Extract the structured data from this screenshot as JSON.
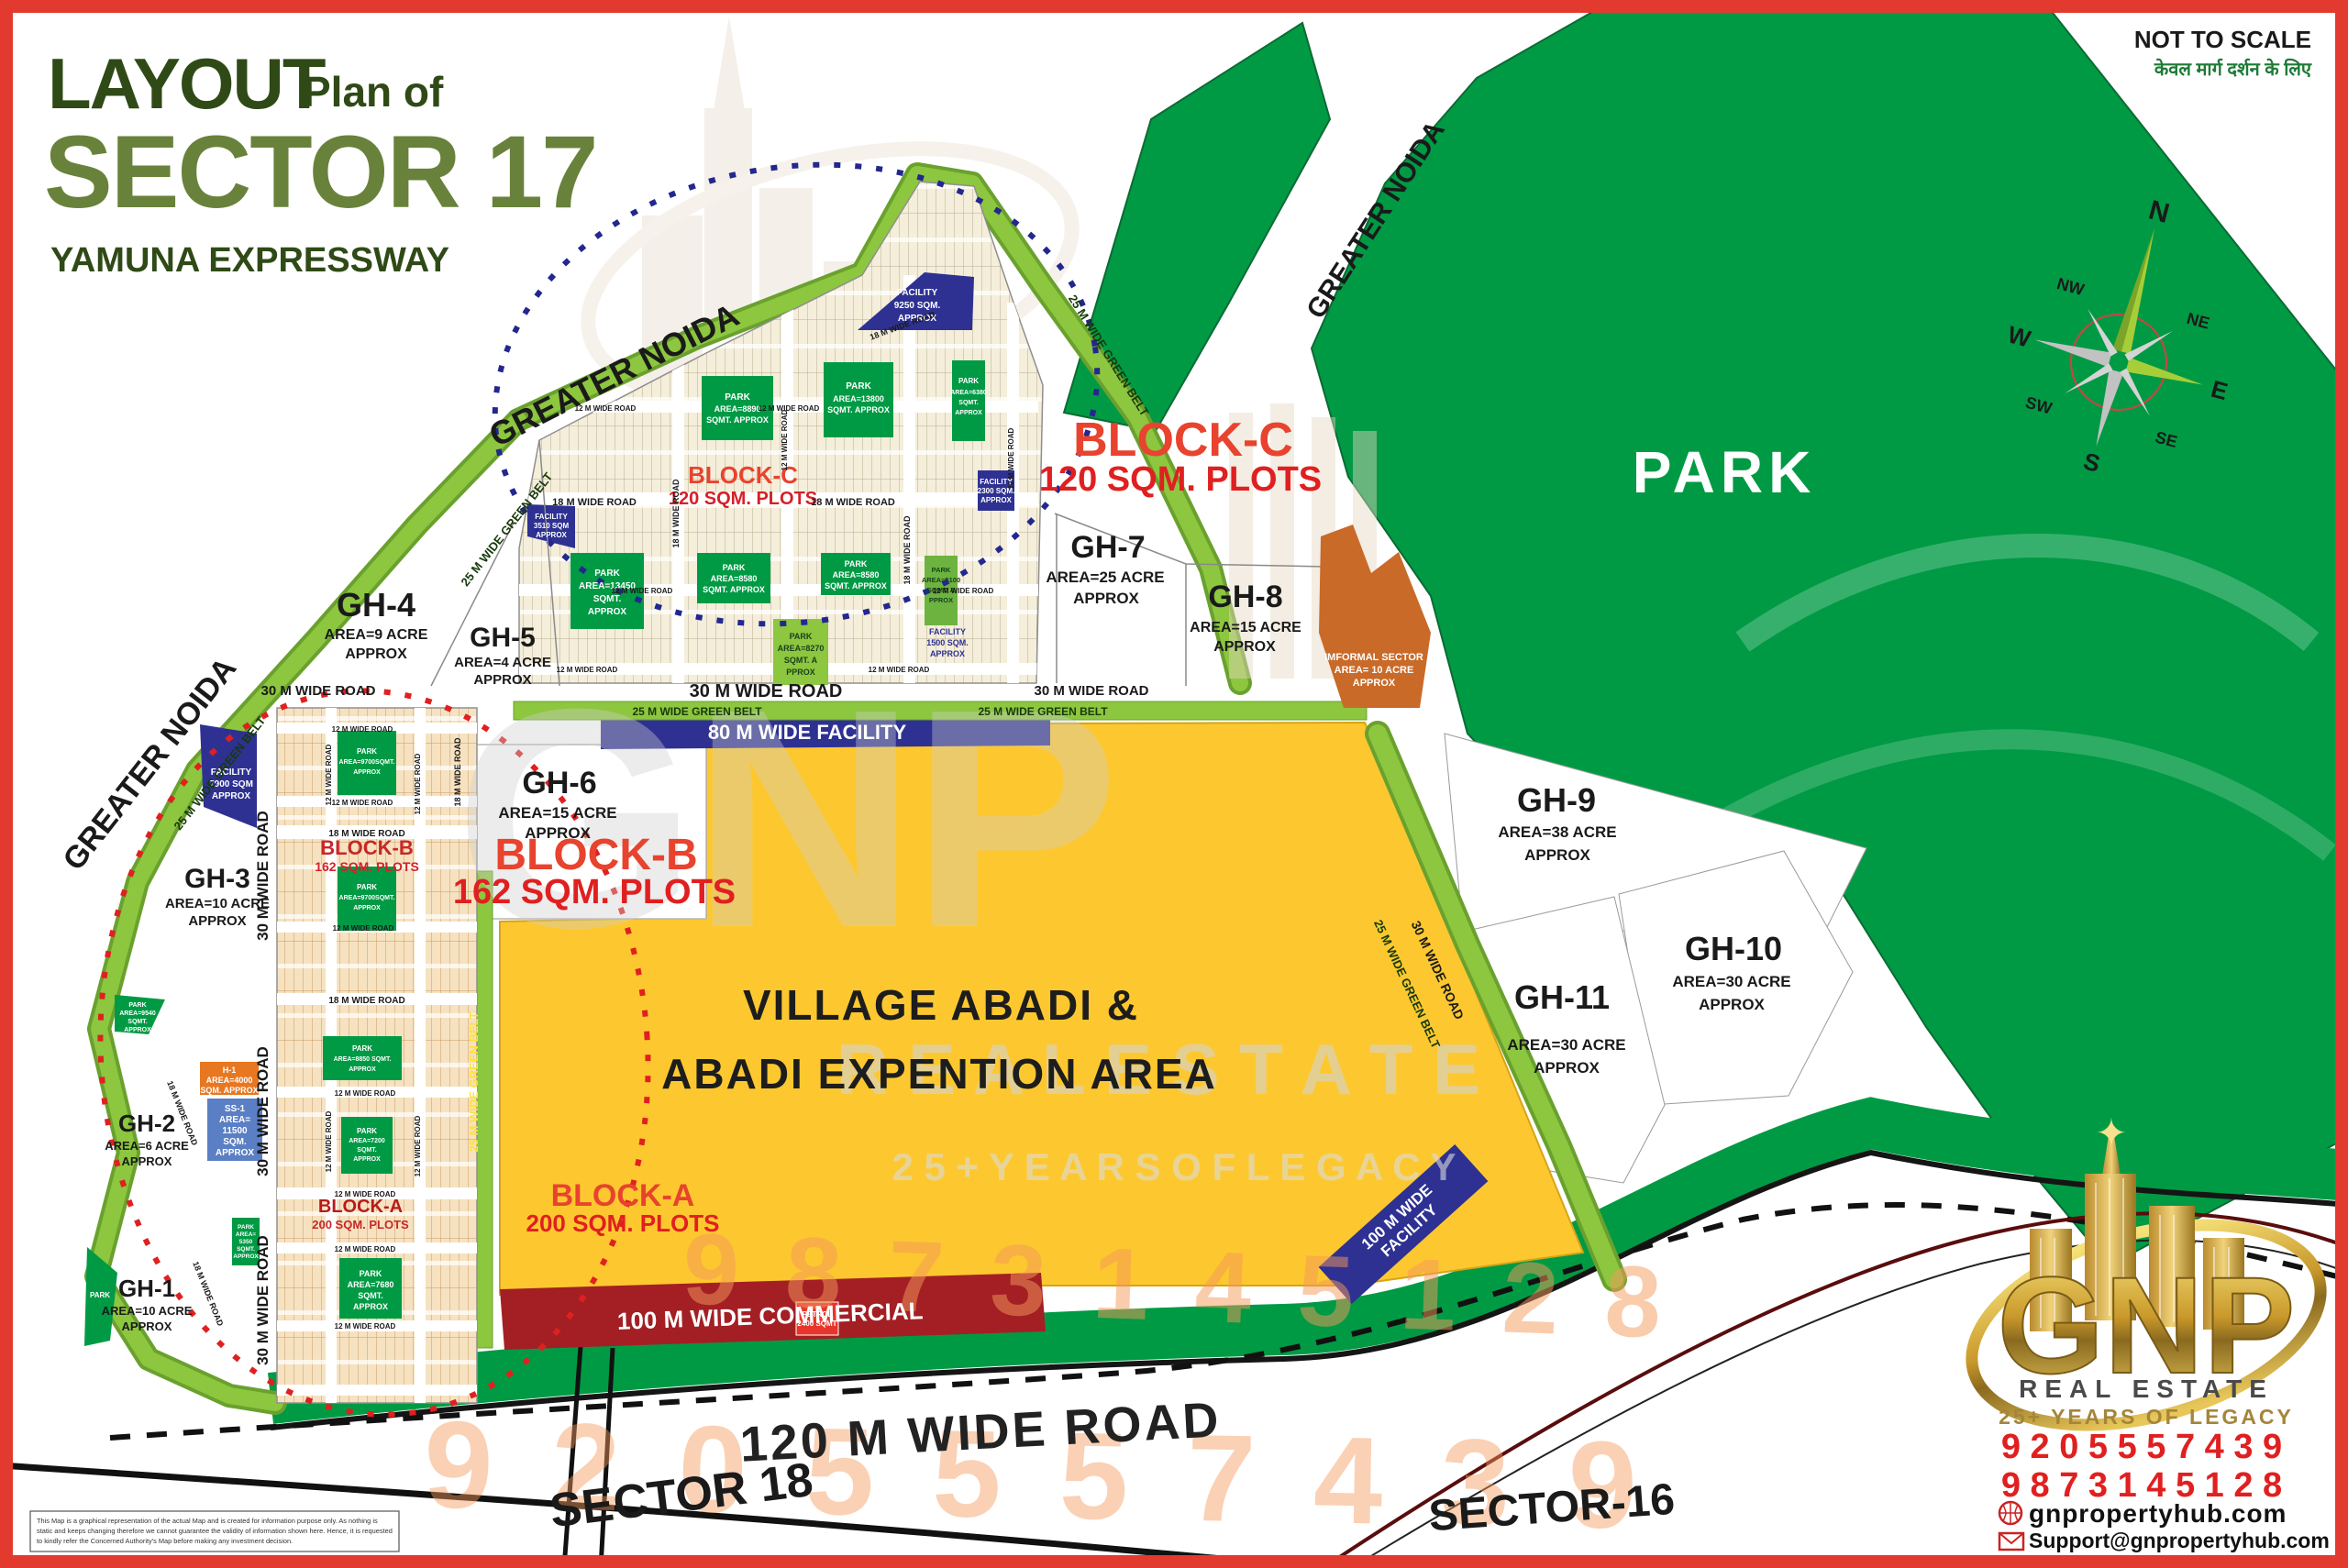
{
  "header": {
    "layout": "LAYOUT",
    "plan_of": "Plan of",
    "sector": "SECTOR 17",
    "expressway": "YAMUNA EXPRESSWAY"
  },
  "note": {
    "not_to_scale": "NOT TO SCALE",
    "hindi": "केवल मार्ग दर्शन के लिए"
  },
  "compass": {
    "n": "N",
    "ne": "NE",
    "e": "E",
    "se": "SE",
    "s": "S",
    "sw": "SW",
    "w": "W",
    "nw": "NW"
  },
  "park_label": "PARK",
  "greater_noida": "GREATER NOIDA",
  "gh": {
    "gh1": {
      "name": "GH-1",
      "area": "AREA=10 ACRE",
      "approx": "APPROX"
    },
    "gh2": {
      "name": "GH-2",
      "area": "AREA=6 ACRE",
      "approx": "APPROX"
    },
    "gh3": {
      "name": "GH-3",
      "area": "AREA=10 ACRE",
      "approx": "APPROX"
    },
    "gh4": {
      "name": "GH-4",
      "area": "AREA=9 ACRE",
      "approx": "APPROX"
    },
    "gh5": {
      "name": "GH-5",
      "area": "AREA=4 ACRE",
      "approx": "APPROX"
    },
    "gh6": {
      "name": "GH-6",
      "area": "AREA=15 ACRE",
      "approx": "APPROX"
    },
    "gh7": {
      "name": "GH-7",
      "area": "AREA=25 ACRE",
      "approx": "APPROX"
    },
    "gh8": {
      "name": "GH-8",
      "area": "AREA=15 ACRE",
      "approx": "APPROX"
    },
    "gh9": {
      "name": "GH-9",
      "area": "AREA=38 ACRE",
      "approx": "APPROX"
    },
    "gh10": {
      "name": "GH-10",
      "area": "AREA=30 ACRE",
      "approx": "APPROX"
    },
    "gh11": {
      "name": "GH-11",
      "area": "AREA=30 ACRE",
      "approx": "APPROX"
    }
  },
  "blocks": {
    "a": {
      "name": "BLOCK-A",
      "plots": "200 SQM. PLOTS"
    },
    "b": {
      "name": "BLOCK-B",
      "plots": "162 SQM. PLOTS"
    },
    "c": {
      "name": "BLOCK-C",
      "plots": "120 SQM. PLOTS"
    }
  },
  "village": {
    "line1": "VILLAGE ABADI &",
    "line2": "ABADI EXPENTION AREA"
  },
  "informal": {
    "line1": "IMFORMAL SECTOR",
    "line2": "AREA= 10 ACRE",
    "line3": "APPROX"
  },
  "roads": {
    "r12": "12 M WIDE ROAD",
    "r18": "18 M WIDE ROAD",
    "r30": "30 M WIDE ROAD",
    "r120": "120 M WIDE ROAD",
    "belt25": "25 M WIDE GREEN BELT",
    "facility80": "80 M WIDE FACILITY",
    "facility100a": "100 M WIDE",
    "facility100b": "FACILITY",
    "commercial": "100 M WIDE COMMERCIAL"
  },
  "sectors": {
    "s18": "SECTOR 18",
    "s16": "SECTOR-16"
  },
  "parks": {
    "p8890": {
      "l1": "PARK",
      "l2": "AREA=8890",
      "l3": "SQMT. APPROX"
    },
    "p13800": {
      "l1": "PARK",
      "l2": "AREA=13800",
      "l3": "SQMT. APPROX"
    },
    "p6380": {
      "l1": "PARK",
      "l2": "AREA=6380",
      "l3": "SQMT.",
      "l4": "APPROX"
    },
    "p13450": {
      "l1": "PARK",
      "l2": "AREA=13450",
      "l3": "SQMT.",
      "l4": "APPROX"
    },
    "p8580": {
      "l1": "PARK",
      "l2": "AREA=8580",
      "l3": "SQMT. APPROX"
    },
    "p8270": {
      "l1": "PARK",
      "l2": "AREA=8270",
      "l3": "SQMT. A",
      "l4": "PPROX"
    },
    "p5100": {
      "l1": "PARK",
      "l2": "AREA=5100",
      "l3": "SQMT. A",
      "l4": "PPROX"
    },
    "p9700": {
      "l1": "PARK",
      "l2": "AREA=9700SQMT.",
      "l3": "APPROX"
    },
    "p9540": {
      "l1": "PARK",
      "l2": "AREA=9540",
      "l3": "SQMT.",
      "l4": "APPROX"
    },
    "p8850": {
      "l1": "PARK",
      "l2": "AREA=8850 SQMT.",
      "l3": "APPROX"
    },
    "p7200": {
      "l1": "PARK",
      "l2": "AREA=7200",
      "l3": "SQMT.",
      "l4": "APPROX"
    },
    "p7680": {
      "l1": "PARK",
      "l2": "AREA=7680",
      "l3": "SQMT.",
      "l4": "APPROX"
    },
    "p5350": {
      "l1": "PARK",
      "l2": "AREA=",
      "l3": "5350",
      "l4": "SQMT.",
      "l5": "APPROX"
    },
    "pwedge": {
      "l1": "PARK"
    }
  },
  "facilities": {
    "f9250": {
      "l1": "FACILITY",
      "l2": "9250 SQM.",
      "l3": "APPROX"
    },
    "f2300": {
      "l1": "FACILITY",
      "l2": "2300 SQM.",
      "l3": "APPROX"
    },
    "f3510": {
      "l1": "FACILITY",
      "l2": "3510 SQM",
      "l3": "APPROX"
    },
    "f1500": {
      "l1": "FACILITY",
      "l2": "1500 SQM.",
      "l3": "APPROX"
    },
    "f7900": {
      "l1": "FACILITY",
      "l2": "7900 SQM",
      "l3": "APPROX"
    },
    "h1": {
      "l1": "H-1",
      "l2": "AREA=4000",
      "l3": "SQM. APPROX"
    },
    "ss1": {
      "l1": "SS-1",
      "l2": "AREA=",
      "l3": "11500",
      "l4": "SQM.",
      "l5": "APPROX"
    },
    "petrol": {
      "l1": "PETROL",
      "l2": "2400 SQMT"
    }
  },
  "watermark": {
    "gnp": "GNP",
    "real_estate": "R E A L   E S T A T E",
    "legacy": "2 5 +   Y E A R S   O F   L E G A C Y",
    "phone1": "9 8 7 3 1 4 5 1 2 8",
    "phone2": "9 2 0 5 5 5 7 4 3 9"
  },
  "brand": {
    "gnp": "GNP",
    "real_estate": "REAL ESTATE",
    "legacy": "25+ YEARS OF LEGACY",
    "phone1": "9 2 0 5 5 5 7 4 3 9",
    "phone2": "9 8 7 3 1 4 5 1 2 8",
    "website": "gnpropertyhub.com",
    "email": "Support@gnpropertyhub.com",
    "star": "✦"
  },
  "disclaimer": {
    "l1": "This Map is a graphical representation of the actual Map and is created for information purpose only. As nothing is",
    "l2": "static and keeps changing therefore we cannot guarantee the validity of information shown here. Hence, it is requested",
    "l3": "to kindly refer the Concerned Authority's Map before making any investment decision."
  },
  "colors": {
    "park_green": "#009a44",
    "belt_green": "#8dc63f",
    "facility_blue": "#2e3192",
    "village_yellow": "#fdc82f",
    "commercial_red": "#a31f24",
    "informal_orange": "#c96a28",
    "accent_red": "#e8432e",
    "plots_red": "#d61f26",
    "title_dark": "#2f4a16",
    "title_olive": "#68823b"
  }
}
